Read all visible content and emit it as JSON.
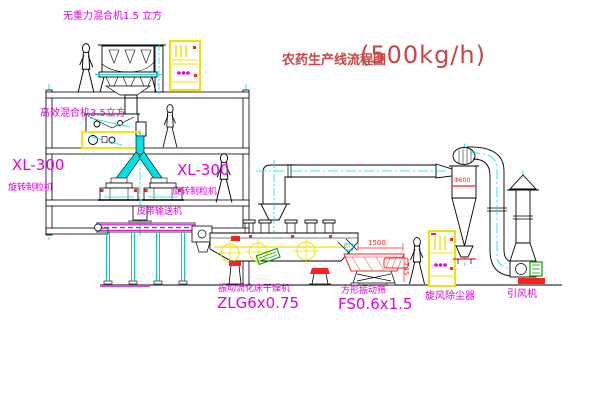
{
  "title": {
    "name": "农药生产线流程图",
    "capacity": "(500kg/h)"
  },
  "labels": {
    "gravity_mixer": "无重力混合机1.5 立方",
    "high_eff_mixer": "高效混合机3.5立方",
    "granulator_left_model": "XL-300",
    "granulator_left_name": "旋转制粒机",
    "granulator_right_model": "XL-300",
    "granulator_right_name": "旋转制粒机",
    "belt_conveyor": "皮带输送机",
    "dryer_name": "振动流化床干燥机",
    "dryer_model": "ZLG6x0.75",
    "screen_name": "方形振动筛",
    "screen_model": "FS0.6x1.5",
    "cyclone": "旋风除尘器",
    "fan": "引风机"
  },
  "dimensions": {
    "screen_length": "1500",
    "screen_height": "745",
    "cyclone_diameter": "Φ600"
  },
  "colors": {
    "label_magenta": "#e100e1",
    "title_red": "#cc4444",
    "machine_red": "#ff2020",
    "cabinet_yellow": "#ffff00",
    "pipe_cyan": "#00e5e5",
    "belt_green": "#00a000",
    "line_black": "#000000"
  }
}
